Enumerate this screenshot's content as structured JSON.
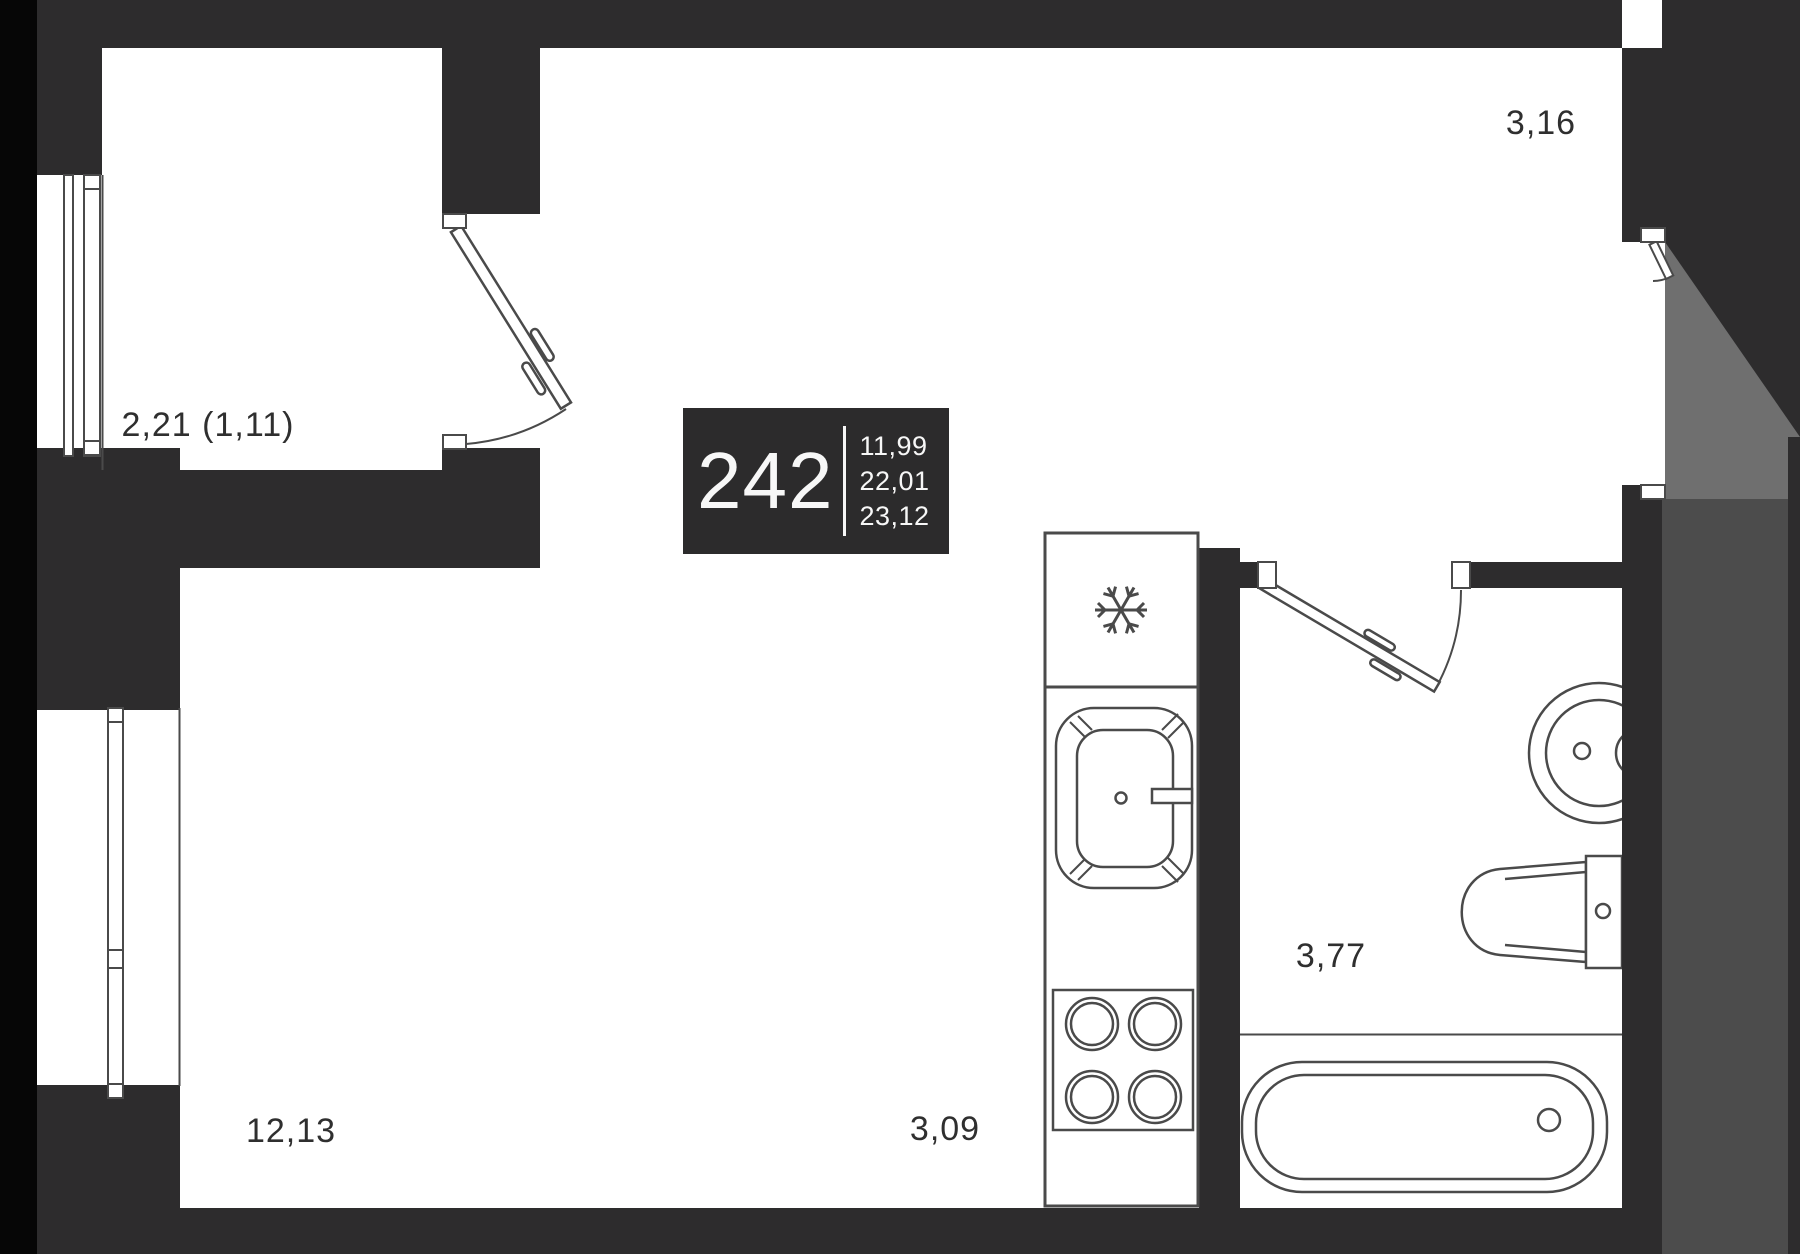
{
  "unit": {
    "number": "242",
    "area_rows": [
      "11,99",
      "22,01",
      "23,12"
    ]
  },
  "labels": {
    "balcony": "2,21 (1,11)",
    "room_top": "3,16",
    "living": "12,13",
    "kitchen": "3,09",
    "bathroom": "3,77"
  },
  "icons": {
    "freezer": "snowflake-icon"
  },
  "colors": {
    "background": "#ffffff",
    "wall": "#2d2c2d",
    "wall_black_edge": "#060606",
    "vestibule_gray": "#6f6f6f",
    "corridor_gray": "#4c4c4c",
    "fixture_line": "#4a4a4a",
    "badge_bg": "#2c2b2c",
    "badge_text": "#f7f7f7",
    "label_text": "#2f2f2f"
  }
}
